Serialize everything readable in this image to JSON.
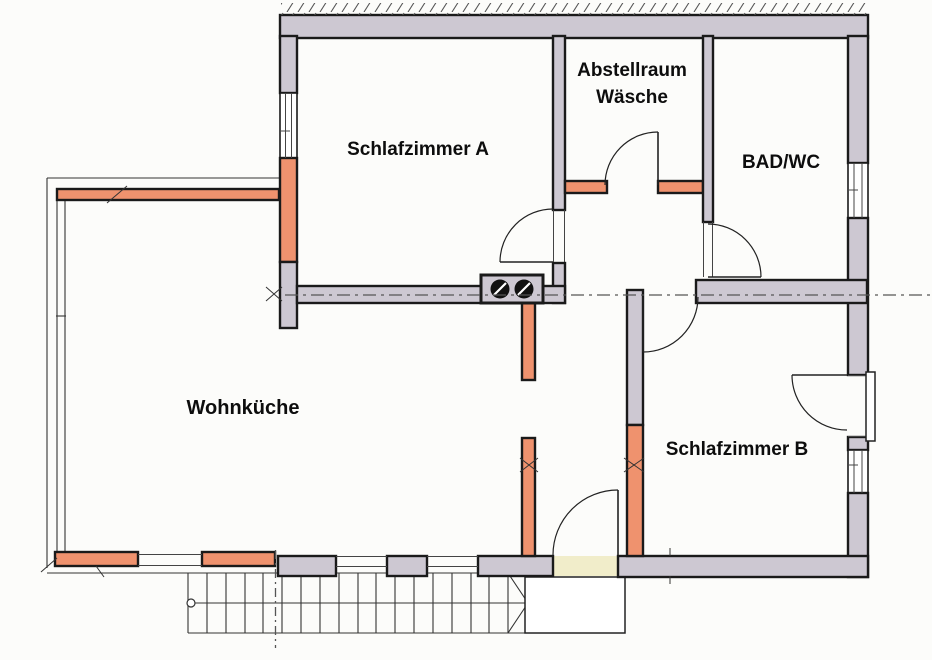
{
  "floor_plan": {
    "type": "architectural-floor-plan",
    "rooms": [
      {
        "id": "schlafzimmer-a",
        "label": "Schlafzimmer A"
      },
      {
        "id": "abstellraum-waesche",
        "label_line1": "Abstellraum",
        "label_line2": "Wäsche"
      },
      {
        "id": "bad-wc",
        "label": "BAD/WC"
      },
      {
        "id": "wohnkueche",
        "label": "Wohnküche"
      },
      {
        "id": "schlafzimmer-b",
        "label": "Schlafzimmer B"
      }
    ],
    "features": [
      "chimney-with-two-flues",
      "staircase",
      "entrance-vestibule",
      "five-door-swings",
      "window-openings",
      "section-dash-line"
    ]
  },
  "colors": {
    "wall_gray": "#cdc8d2",
    "wall_orange": "#ef926e",
    "outline": "#1a1a1a",
    "entry_yellow": "#f1edca",
    "line": "#333333",
    "background": "#fcfcfa"
  }
}
